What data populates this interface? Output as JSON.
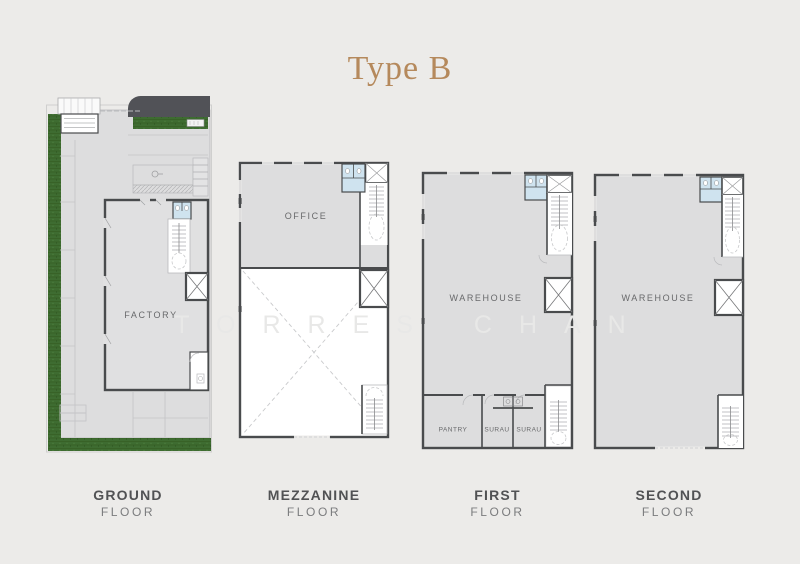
{
  "title": "Type B",
  "watermark": "TORRES CHAN",
  "floor_captions": [
    {
      "line1": "GROUND",
      "line2": "FLOOR"
    },
    {
      "line1": "MEZZANINE",
      "line2": "FLOOR"
    },
    {
      "line1": "FIRST",
      "line2": "FLOOR"
    },
    {
      "line1": "SECOND",
      "line2": "FLOOR"
    }
  ],
  "rooms": {
    "factory": "FACTORY",
    "office": "OFFICE",
    "warehouse_first": "WAREHOUSE",
    "warehouse_second": "WAREHOUSE",
    "pantry": "PANTRY",
    "surau_left": "SURAU",
    "surau_right": "SURAU"
  },
  "colors": {
    "background": "#ECEBE9",
    "accent": "#B5895C",
    "wall": "#494B4D",
    "floor_fill": "#DDDDDE",
    "wet_area": "#CFE3EF",
    "grass": "#3E6C31",
    "caption_dark": "#515254",
    "caption_light": "#7B7C7E",
    "room_label": "#68696B",
    "watermark": "#E8E8E7"
  }
}
